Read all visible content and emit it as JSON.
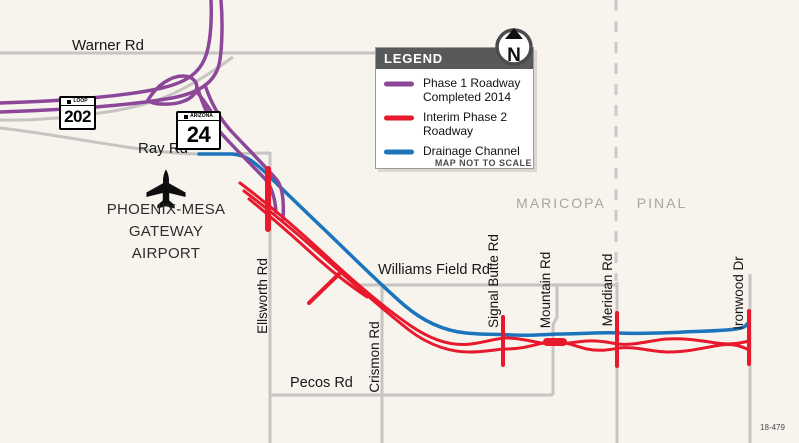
{
  "figure_number": "18-479",
  "north_arrow": {
    "label": "N"
  },
  "legend": {
    "title": "LEGEND",
    "items": [
      {
        "name": "phase1",
        "label": "Phase 1 Roadway Completed 2014",
        "color": "#8c4799"
      },
      {
        "name": "interim-phase2",
        "label": "Interim Phase 2 Roadway",
        "color": "#e8192c"
      },
      {
        "name": "drainage-channel",
        "label": "Drainage Channel",
        "color": "#1c75bc"
      }
    ],
    "note": "MAP NOT TO SCALE"
  },
  "shields": {
    "loop202": {
      "banner": "LOOP",
      "number": "202"
    },
    "sr24": {
      "banner": "ARIZONA",
      "number": "24"
    }
  },
  "airport": {
    "name_lines": [
      "PHOENIX-MESA",
      "GATEWAY",
      "AIRPORT"
    ]
  },
  "counties": {
    "west": "MARICOPA",
    "east": "PINAL"
  },
  "roads": {
    "warner": "Warner Rd",
    "ray": "Ray Rd",
    "williams_field": "Williams Field Rd",
    "pecos": "Pecos Rd",
    "ellsworth": "Ellsworth Rd",
    "crismon": "Crismon Rd",
    "signal_butte": "Signal Butte Rd",
    "mountain": "Mountain Rd",
    "meridian": "Meridian Rd",
    "ironwood": "Ironwood Dr"
  },
  "colors": {
    "phase1_purple": "#8c4799",
    "interim_red": "#e8192c",
    "drainage_blue": "#1c75bc",
    "road_gray": "#c6c5c2",
    "county_line_gray": "#cacacc",
    "background": "#f7f4ee"
  }
}
